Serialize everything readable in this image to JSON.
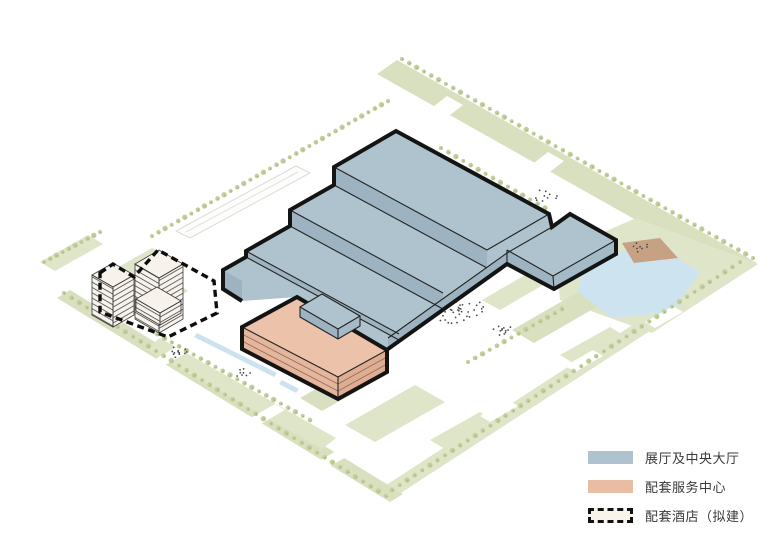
{
  "legend": {
    "items": [
      {
        "id": "exhibition",
        "label": "展厅及中央大厅",
        "swatch_color": "#aec3ce",
        "swatch_style": "solid"
      },
      {
        "id": "service",
        "label": "配套服务中心",
        "swatch_color": "#e9bca4",
        "swatch_style": "solid"
      },
      {
        "id": "hotel",
        "label": "配套酒店（拟建）",
        "swatch_color": "#f8f4ec",
        "swatch_style": "dashed"
      }
    ]
  },
  "colors": {
    "exhibition_roof": "#aec3ce",
    "exhibition_face_dark": "#9db3c1",
    "exhibition_face_light": "#a5bac7",
    "service_roof": "#ecc2aa",
    "service_face_sw": "#e5b59c",
    "service_face_se": "#e0ad93",
    "hotel_cream": "#f7f3ec",
    "green": "#dfe5c8",
    "green_alt": "#d9e0bf",
    "tree": "#c2ce9c",
    "tree_dark": "#a8b77c",
    "pond": "#cde3f0",
    "canal": "#cde2ef",
    "beach": "#c7a183",
    "outline": "#141414"
  }
}
